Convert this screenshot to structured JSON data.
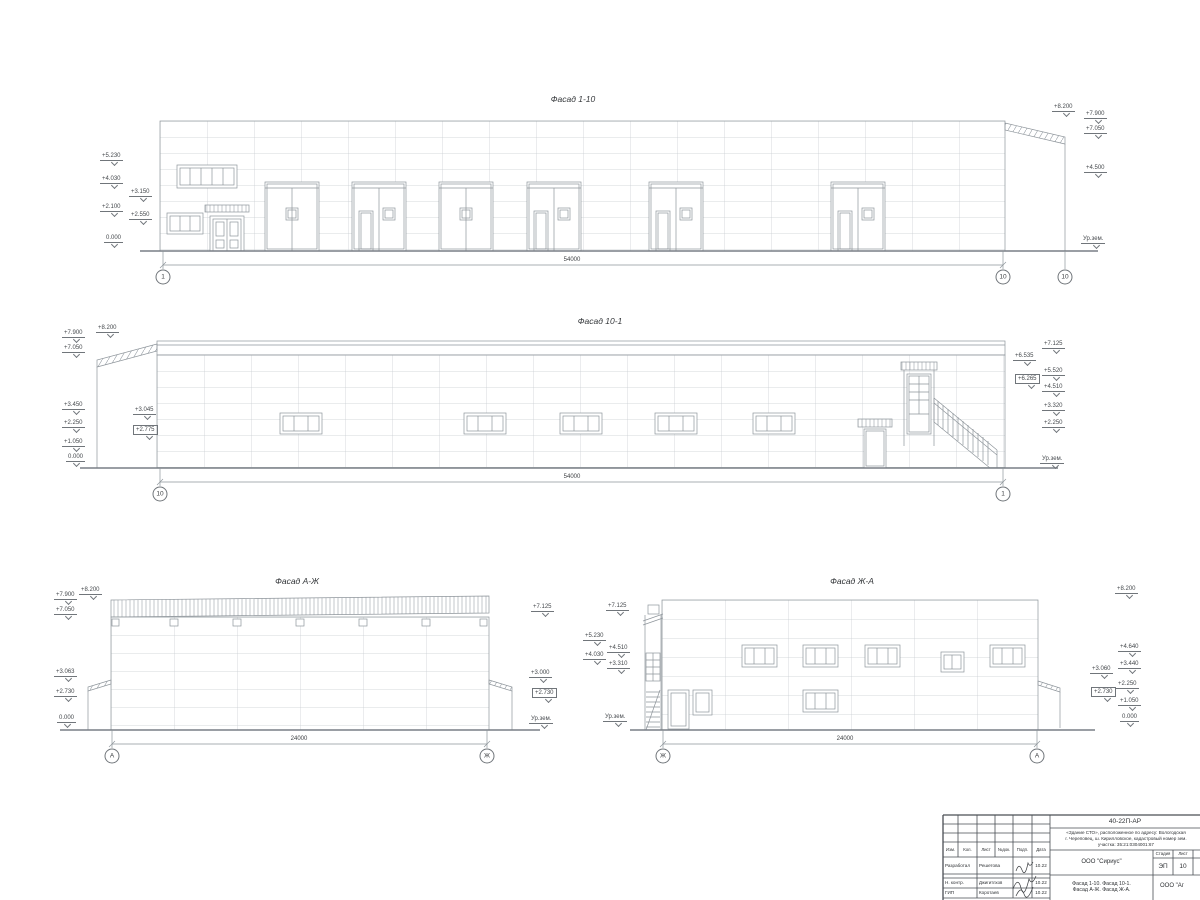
{
  "page": {
    "background": "#ffffff",
    "line_color": "#8e959b",
    "panel_grid_color": "#c6cbd0",
    "stamp_line_color": "#4a4f54",
    "text_color": "#3c3f42"
  },
  "facades": [
    {
      "title": {
        "text": "Фасад 1-10",
        "x": 573,
        "y": 95
      },
      "dim": {
        "t": "54000",
        "x": 572,
        "y": 257
      },
      "axes": [
        {
          "t": "1",
          "x": 163,
          "y": 277
        },
        {
          "t": "10",
          "x": 1003,
          "y": 277
        },
        {
          "t": "10",
          "x": 1065,
          "y": 277
        }
      ],
      "marks": [
        {
          "t": "+5.230",
          "x": 100,
          "y": 153
        },
        {
          "t": "+4.030",
          "x": 100,
          "y": 176
        },
        {
          "t": "+3.150",
          "x": 129,
          "y": 189
        },
        {
          "t": "+2.100",
          "x": 100,
          "y": 204
        },
        {
          "t": "+2.550",
          "x": 129,
          "y": 212
        },
        {
          "t": "0.000",
          "x": 104,
          "y": 235
        },
        {
          "t": "+8.200",
          "x": 1052,
          "y": 104
        },
        {
          "t": "+7.900",
          "x": 1084,
          "y": 111
        },
        {
          "t": "+7.050",
          "x": 1084,
          "y": 126
        },
        {
          "t": "+4.500",
          "x": 1084,
          "y": 165
        },
        {
          "t": "Ур.зем.",
          "x": 1081,
          "y": 236
        }
      ]
    },
    {
      "title": {
        "text": "Фасад 10-1",
        "x": 600,
        "y": 317
      },
      "dim": {
        "t": "54000",
        "x": 572,
        "y": 474
      },
      "axes": [
        {
          "t": "10",
          "x": 160,
          "y": 494
        },
        {
          "t": "1",
          "x": 1003,
          "y": 494
        }
      ],
      "marks": [
        {
          "t": "+8.200",
          "x": 96,
          "y": 325
        },
        {
          "t": "+7.900",
          "x": 62,
          "y": 330
        },
        {
          "t": "+7.050",
          "x": 62,
          "y": 345
        },
        {
          "t": "+3.450",
          "x": 62,
          "y": 402
        },
        {
          "t": "+3.045",
          "x": 133,
          "y": 407
        },
        {
          "t": "+2.250",
          "x": 62,
          "y": 420
        },
        {
          "t": "+2.775",
          "x": 133,
          "y": 425,
          "b": true
        },
        {
          "t": "+1.050",
          "x": 62,
          "y": 439
        },
        {
          "t": "0.000",
          "x": 66,
          "y": 454
        },
        {
          "t": "+7.125",
          "x": 1042,
          "y": 341
        },
        {
          "t": "+6.535",
          "x": 1013,
          "y": 353
        },
        {
          "t": "+6.265",
          "x": 1015,
          "y": 374,
          "b": true
        },
        {
          "t": "+5.520",
          "x": 1042,
          "y": 368
        },
        {
          "t": "+4.510",
          "x": 1042,
          "y": 384
        },
        {
          "t": "+3.320",
          "x": 1042,
          "y": 403
        },
        {
          "t": "+2.250",
          "x": 1042,
          "y": 420
        },
        {
          "t": "Ур.зем.",
          "x": 1040,
          "y": 456
        }
      ]
    },
    {
      "title": {
        "text": "Фасад А-Ж",
        "x": 297,
        "y": 577
      },
      "dim": {
        "t": "24000",
        "x": 299,
        "y": 736
      },
      "axes": [
        {
          "t": "А",
          "x": 112,
          "y": 756
        },
        {
          "t": "Ж",
          "x": 487,
          "y": 756
        }
      ],
      "marks": [
        {
          "t": "+7.900",
          "x": 54,
          "y": 592
        },
        {
          "t": "+8.200",
          "x": 79,
          "y": 587
        },
        {
          "t": "+7.050",
          "x": 54,
          "y": 607
        },
        {
          "t": "+3.063",
          "x": 54,
          "y": 669
        },
        {
          "t": "+2.730",
          "x": 54,
          "y": 689
        },
        {
          "t": "0.000",
          "x": 57,
          "y": 715
        },
        {
          "t": "+7.125",
          "x": 531,
          "y": 604
        },
        {
          "t": "+3.000",
          "x": 529,
          "y": 670
        },
        {
          "t": "+2.730",
          "x": 532,
          "y": 688,
          "b": true
        },
        {
          "t": "Ур.зем.",
          "x": 529,
          "y": 716
        }
      ]
    },
    {
      "title": {
        "text": "Фасад Ж-А",
        "x": 852,
        "y": 577
      },
      "dim": {
        "t": "24000",
        "x": 845,
        "y": 736
      },
      "axes": [
        {
          "t": "Ж",
          "x": 663,
          "y": 756
        },
        {
          "t": "А",
          "x": 1037,
          "y": 756
        }
      ],
      "marks": [
        {
          "t": "+7.125",
          "x": 606,
          "y": 603
        },
        {
          "t": "+5.230",
          "x": 583,
          "y": 633
        },
        {
          "t": "+4.510",
          "x": 607,
          "y": 645
        },
        {
          "t": "+4.030",
          "x": 583,
          "y": 652
        },
        {
          "t": "+3.310",
          "x": 607,
          "y": 661
        },
        {
          "t": "Ур.зем.",
          "x": 603,
          "y": 714
        },
        {
          "t": "+8.200",
          "x": 1115,
          "y": 586
        },
        {
          "t": "+4.640",
          "x": 1118,
          "y": 644
        },
        {
          "t": "+3.440",
          "x": 1118,
          "y": 661
        },
        {
          "t": "+3.060",
          "x": 1090,
          "y": 666
        },
        {
          "t": "+2.250",
          "x": 1116,
          "y": 681
        },
        {
          "t": "+2.730",
          "x": 1091,
          "y": 687,
          "b": true
        },
        {
          "t": "+1.050",
          "x": 1118,
          "y": 698
        },
        {
          "t": "0.000",
          "x": 1120,
          "y": 714
        }
      ]
    }
  ],
  "titleblock": {
    "code": "40-22П-АР",
    "desc_lines": [
      "«Здание СТО», расположенное по адресу: Вологодская",
      "г. Череповец, ш. Кирилловское, кадастровый номер зем.",
      "участка: 35:21:0304001:67"
    ],
    "header": [
      "Изм.",
      "Кол.",
      "Лист",
      "№док.",
      "Подп.",
      "Дата"
    ],
    "rows": [
      {
        "role": "Разработал",
        "name": "Решетова",
        "date": "10.22"
      },
      {
        "role": "Н. контр.",
        "name": "Джигитлхов",
        "date": "10.22"
      },
      {
        "role": "ГИП",
        "name": "Коротаев",
        "date": "10.22"
      }
    ],
    "org": "ООО \"Сириус\"",
    "stage_label": "Стадия",
    "list_label": "Лист",
    "stage": "ЭП",
    "sheet_no": "10",
    "object_lines": [
      "Фасад 1-10. Фасад 10-1.",
      "Фасад А-Ж. Фасад Ж-А."
    ],
    "org2": "ООО \"Аг"
  }
}
